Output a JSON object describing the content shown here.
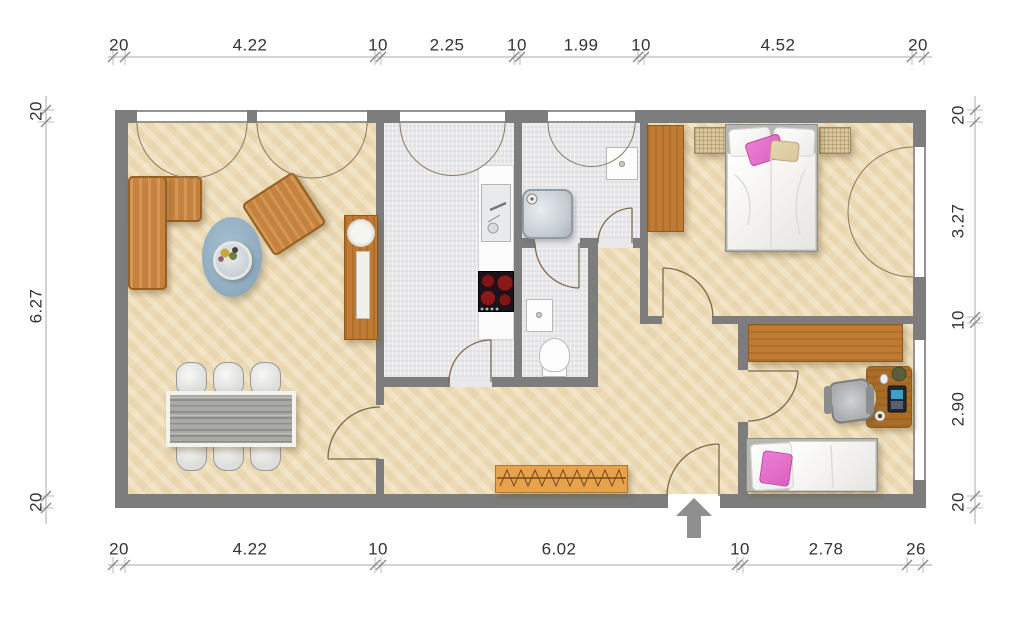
{
  "dimensions": {
    "top": [
      "20",
      "4.22",
      "10",
      "2.25",
      "10",
      "1.99",
      "10",
      "4.52",
      "20"
    ],
    "bottom": [
      "20",
      "4.22",
      "10",
      "6.02",
      "10",
      "2.78",
      "26"
    ],
    "left": [
      "20",
      "6.27",
      "20"
    ],
    "right": [
      "20",
      "3.27",
      "10",
      "2.90",
      "20"
    ]
  },
  "palette": {
    "wall": "#7d7d7d",
    "floor_beige": "#f0e1bf",
    "floor_tile": "#e8e8ea",
    "wood": "#c07a33",
    "wood_dark": "#8a5a1f",
    "sofa": "#c5823f",
    "sofa_dark": "#96601f",
    "rug": "#92aec1",
    "table_gray": "#a9a9a5",
    "chair": "#dddddb",
    "pink": "#dd5fc2",
    "beige_pillow": "#d9c69c",
    "stove": "#19131b",
    "burner": "#7e1616",
    "arrow": "#8f8f8f",
    "dim_text": "#333333",
    "dim_line": "#a8a8a8",
    "arc": "#7d6a50"
  }
}
